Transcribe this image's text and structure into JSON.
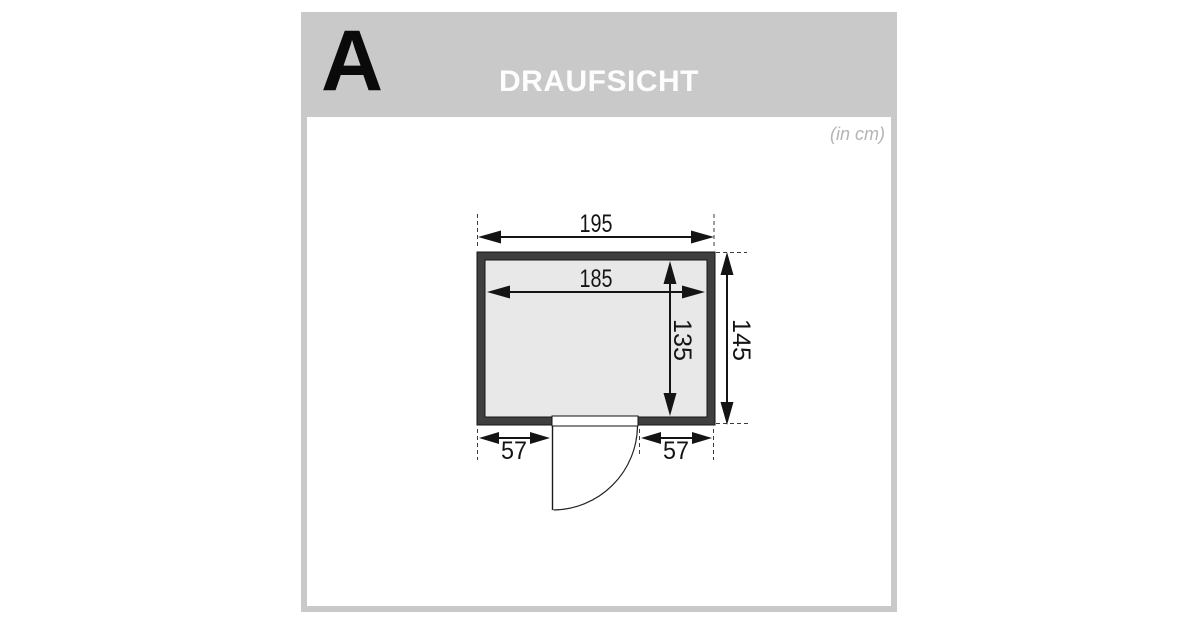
{
  "panel": {
    "section_label": "A",
    "title": "DRAUFSICHT",
    "units_note": "(in cm)"
  },
  "diagram": {
    "type": "floor-plan-top-view",
    "dimensions": {
      "outer_width": "195",
      "inner_width": "185",
      "inner_depth": "135",
      "outer_depth": "145",
      "door_left_offset": "57",
      "door_right_offset": "57"
    },
    "colors": {
      "wall": "#3f3f3f",
      "interior": "#e8e8e8",
      "panel_gray": "#c9c9c9",
      "header_text": "#fdfdfd",
      "units_text": "#b5b5b5",
      "line": "#141414"
    }
  }
}
